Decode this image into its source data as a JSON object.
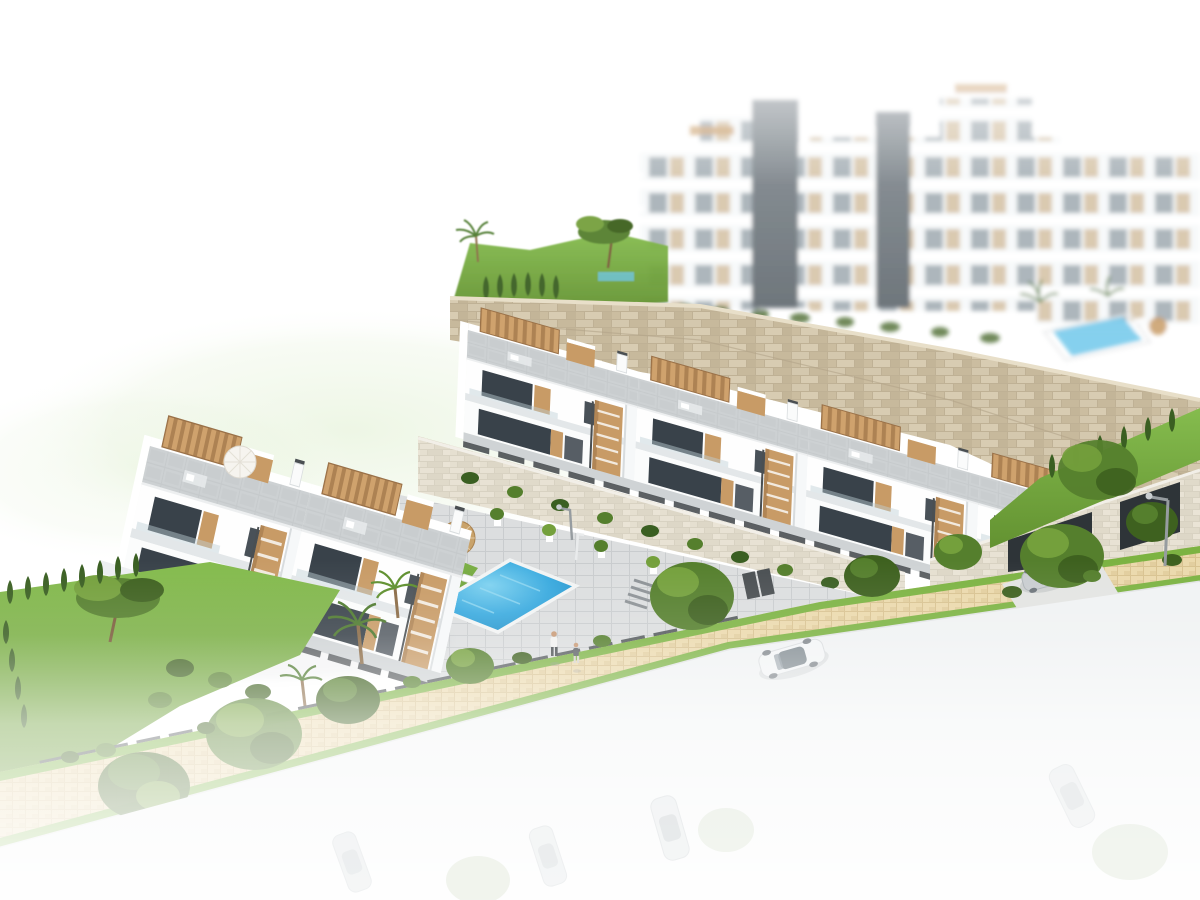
{
  "meta": {
    "title": "Aerial 3D architectural render of a hillside residential development",
    "type": "architectural-visualization",
    "width_px": 1200,
    "height_px": 900,
    "visible_text": "none"
  },
  "palette": {
    "white": "#FFFFFF",
    "building_shade": "#E7EAEC",
    "paver": "#C7CBCD",
    "paver_line": "#B5B9BB",
    "paver_light": "#DADCDD",
    "wood": "#C89B66",
    "wood_dark": "#A0774A",
    "glass": "#39424A",
    "railing": "#4A4F52",
    "stone": "#CDBFA3",
    "stone_dark": "#B9AB8E",
    "stone_block": "#D6CAB0",
    "stone_light": "#E4DED0",
    "tile": "#E9D7A9",
    "tile_line": "#D3BD8C",
    "grass": "#7CB342",
    "grass_dark": "#5E8F2D",
    "tree": "#557F2D",
    "tree_light": "#74A03C",
    "tree_dark": "#3E611F",
    "cypress": "#3A5F22",
    "pool": "#2E9FD8",
    "pool_light": "#74CBEE",
    "road": "#F0F2F3",
    "car_body": "#EDEFF0",
    "car_glass": "#79838A",
    "skin": "#C89A76",
    "lamp": "#969CA0",
    "apt_window": "#A7B1B7",
    "apt_panel": "#D8C6AB",
    "apt_shaft": "#6C747A",
    "halo_green": "#DDEECB"
  },
  "scene": {
    "background_apartments": {
      "label": "hazy white apartment blocks with tan panels and two dark lift shafts",
      "blocks": 4,
      "visible_floors": 5
    },
    "hillside": {
      "label": "green hilltop with pine and palm above long stone retaining wall"
    },
    "retaining_wall": {
      "label": "beige natural-stone retaining wall sweeping to the right"
    },
    "background_pool": {
      "label": "small community pool beside the apartments, upper right"
    },
    "upper_townhouse_row": {
      "label": "diagonal row of white townhouses with roof terraces, wood pergolas and side stairs",
      "units": 4
    },
    "left_townhouse_block": {
      "label": "left block of white townhouses with roof terrace and parasol",
      "units": 2
    },
    "embankment": {
      "label": "light stone embankment wall with shrub strip between row and pool deck"
    },
    "pool_area": {
      "label": "communal pool deck",
      "parasols": 2,
      "sun_loungers": 6,
      "swimmers_or_bathers": 1
    },
    "people": {
      "count": 2,
      "label": "two pedestrians on the sidewalk"
    },
    "sidewalk": {
      "label": "tan paved sidewalk with grass verges and street trees"
    },
    "boundary": {
      "label": "dark slatted fence on low stone wall with hedge"
    },
    "driveway": {
      "label": "concrete driveway into basement garage with silver sports car"
    },
    "street": {
      "label": "street fading to white with one silver sedan and faint parked cars"
    },
    "cars": {
      "clearly_visible": 2,
      "faded_ghosts": 4
    },
    "street_lamps": {
      "count": 2
    },
    "vegetation": {
      "labels": [
        "pine tree",
        "palm trees",
        "cypress hedge",
        "round street trees",
        "lawns"
      ]
    }
  }
}
